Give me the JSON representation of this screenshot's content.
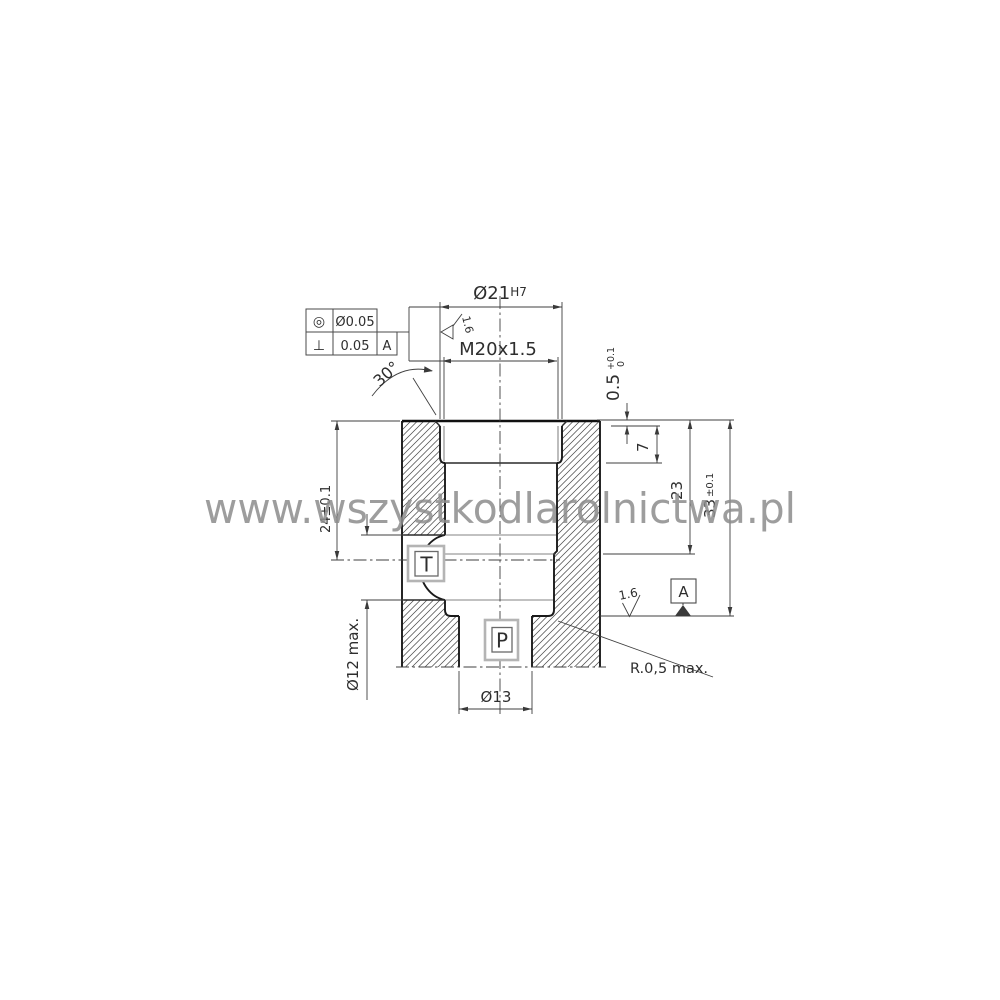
{
  "watermark": {
    "text": "www.wszystkodlarolnictwa.pl",
    "color": "#8d8d8d"
  },
  "fcf": {
    "row1": {
      "symbol": "◎",
      "value": "Ø0.05"
    },
    "row2": {
      "symbol": "⊥",
      "value": "0.05",
      "datum": "A"
    }
  },
  "dims": {
    "bore": {
      "value": "Ø21",
      "tol": "H7"
    },
    "thread": {
      "value": "M20x1.5"
    },
    "angle": {
      "value": "30°"
    },
    "recess": {
      "value": "0.5",
      "tol_hi": "+0.1",
      "tol_lo": "0"
    },
    "thread_depth": {
      "value": "7"
    },
    "step_depth": {
      "value": "23"
    },
    "total_depth": {
      "value": "33",
      "tol": "±0.1"
    },
    "port_axis": {
      "value": "24±0.1"
    },
    "port_dia": {
      "value": "Ø12 max."
    },
    "outlet_dia": {
      "value": "Ø13"
    },
    "fillet": {
      "value": "R.0,5 max."
    }
  },
  "roughness": {
    "thread": "1.6",
    "seat": "1.6"
  },
  "ports": {
    "t": "T",
    "p": "P"
  },
  "datum": {
    "label": "A"
  },
  "colors": {
    "line": "#3f3f3f",
    "outline": "#1a1a1a",
    "hatch": "#4a4a4a",
    "label_box": "#b4b4b4",
    "watermark": "#8d8d8d"
  }
}
